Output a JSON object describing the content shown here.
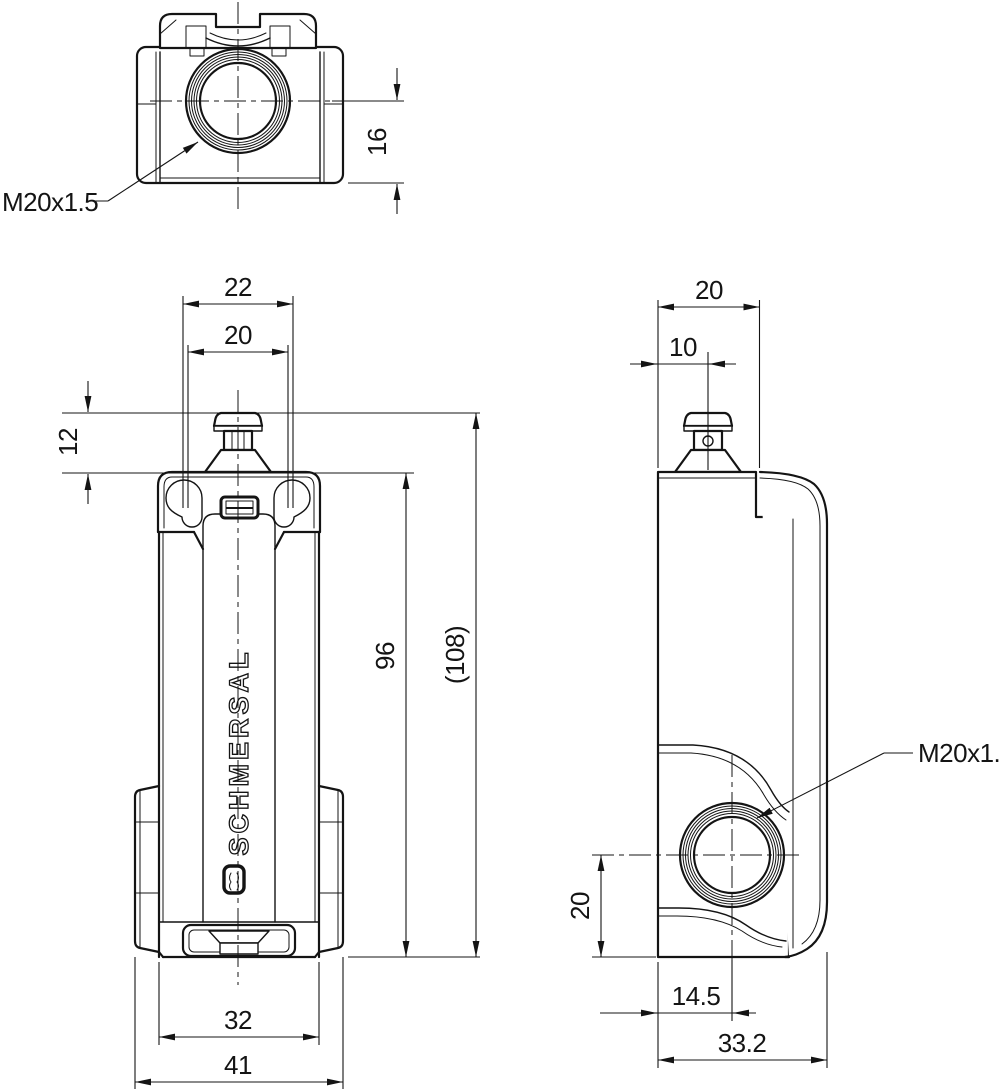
{
  "drawing": {
    "brand": "SCHMERSAL",
    "labels": {
      "thread_top": "M20x1.5",
      "thread_side": "M20x1.5"
    },
    "dimensions": {
      "top": {
        "d16": "16"
      },
      "front": {
        "d22": "22",
        "d20": "20",
        "d12": "12",
        "d96": "96",
        "d108": "(108)",
        "d32": "32",
        "d41": "41"
      },
      "side": {
        "d20_top": "20",
        "d10": "10",
        "d20_left": "20",
        "d14_5": "14.5",
        "d33_2": "33.2"
      }
    },
    "colors": {
      "line": "#141414",
      "background": "#ffffff"
    }
  }
}
